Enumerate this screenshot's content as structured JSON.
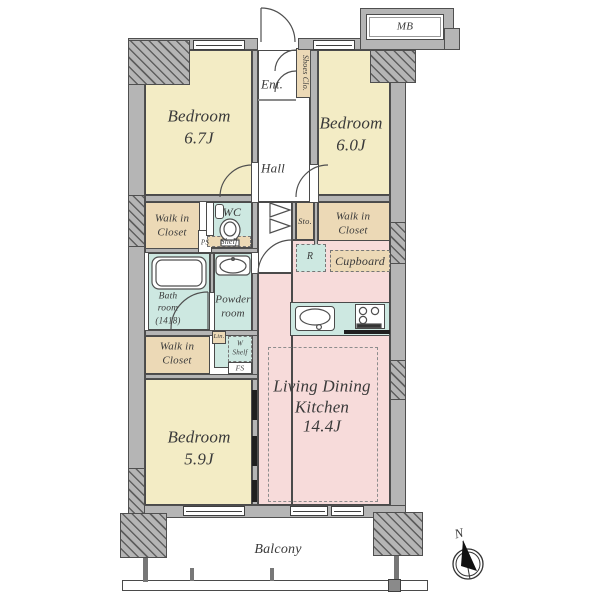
{
  "rooms": {
    "bedroom67": {
      "name": "Bedroom",
      "size": "6.7J"
    },
    "bedroom60": {
      "name": "Bedroom",
      "size": "6.0J"
    },
    "bedroom59": {
      "name": "Bedroom",
      "size": "5.9J"
    },
    "ldk": {
      "line1": "Living Dining",
      "line2": "Kitchen",
      "size": "14.4J"
    },
    "entrance": {
      "label": "Ent."
    },
    "shoes_closet": {
      "label": "Shoes Clo."
    },
    "hall": {
      "label": "Hall"
    },
    "meter_box": {
      "label": "MB"
    },
    "wic_top": {
      "line1": "Walk in",
      "line2": "Closet"
    },
    "wic_right": {
      "line1": "Walk in",
      "line2": "Closet"
    },
    "wic_bottom": {
      "line1": "Walk in",
      "line2": "Closet"
    },
    "pipe_space": {
      "label": "PS"
    },
    "wc": {
      "label": "WC"
    },
    "shelf": {
      "label": "Shelf"
    },
    "storage": {
      "label": "Sto."
    },
    "refrigerator": {
      "label": "R"
    },
    "cupboard": {
      "label": "Cupboard"
    },
    "bathroom": {
      "line1": "Bath",
      "line2": "room",
      "line3": "(1418)"
    },
    "powder_room": {
      "line1": "Powder",
      "line2": "room"
    },
    "linen": {
      "label": "Lin."
    },
    "washer_shelf": {
      "line1": "W",
      "line2": "Shelf"
    },
    "fire_space": {
      "label": "FS"
    },
    "balcony": {
      "label": "Balcony"
    }
  },
  "compass": {
    "north_label": "N"
  },
  "colors": {
    "bedroom_fill": "#f3ecc5",
    "closet_fill": "#ecd9b6",
    "wet_area_fill": "#cde8e1",
    "ldk_fill": "#f7dbda",
    "wall_fill": "#b5b5b5"
  }
}
